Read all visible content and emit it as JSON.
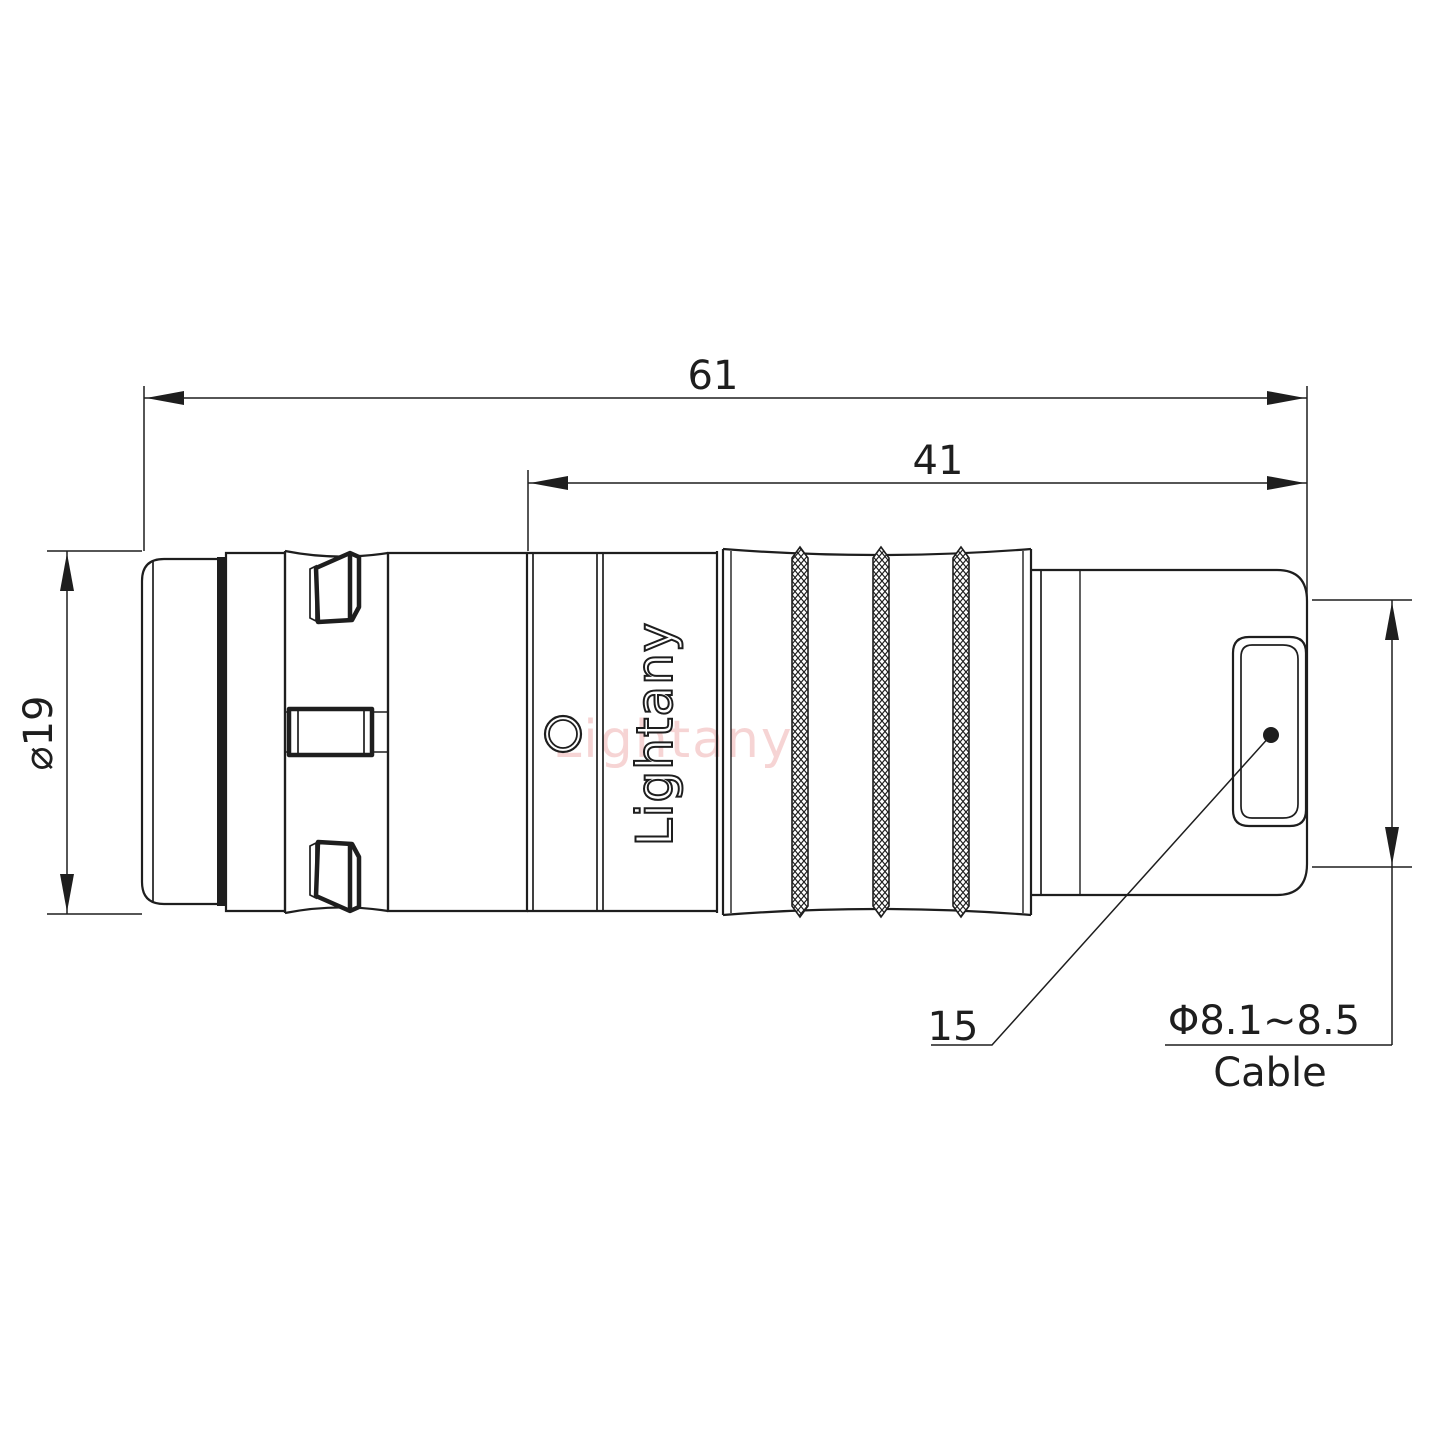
{
  "drawing": {
    "brand_engraved": "Lightany",
    "watermark_text": "Lightany",
    "dimensions": {
      "total_length": "61",
      "rear_length": "41",
      "body_diameter": "⌀19",
      "boot_reference": "15",
      "cable_diameter_range": "Φ8.1~8.5",
      "cable_label": "Cable"
    },
    "colors": {
      "line": "#1e1e1e",
      "watermark_pink": "#f0b2b2",
      "background": "#ffffff"
    }
  }
}
